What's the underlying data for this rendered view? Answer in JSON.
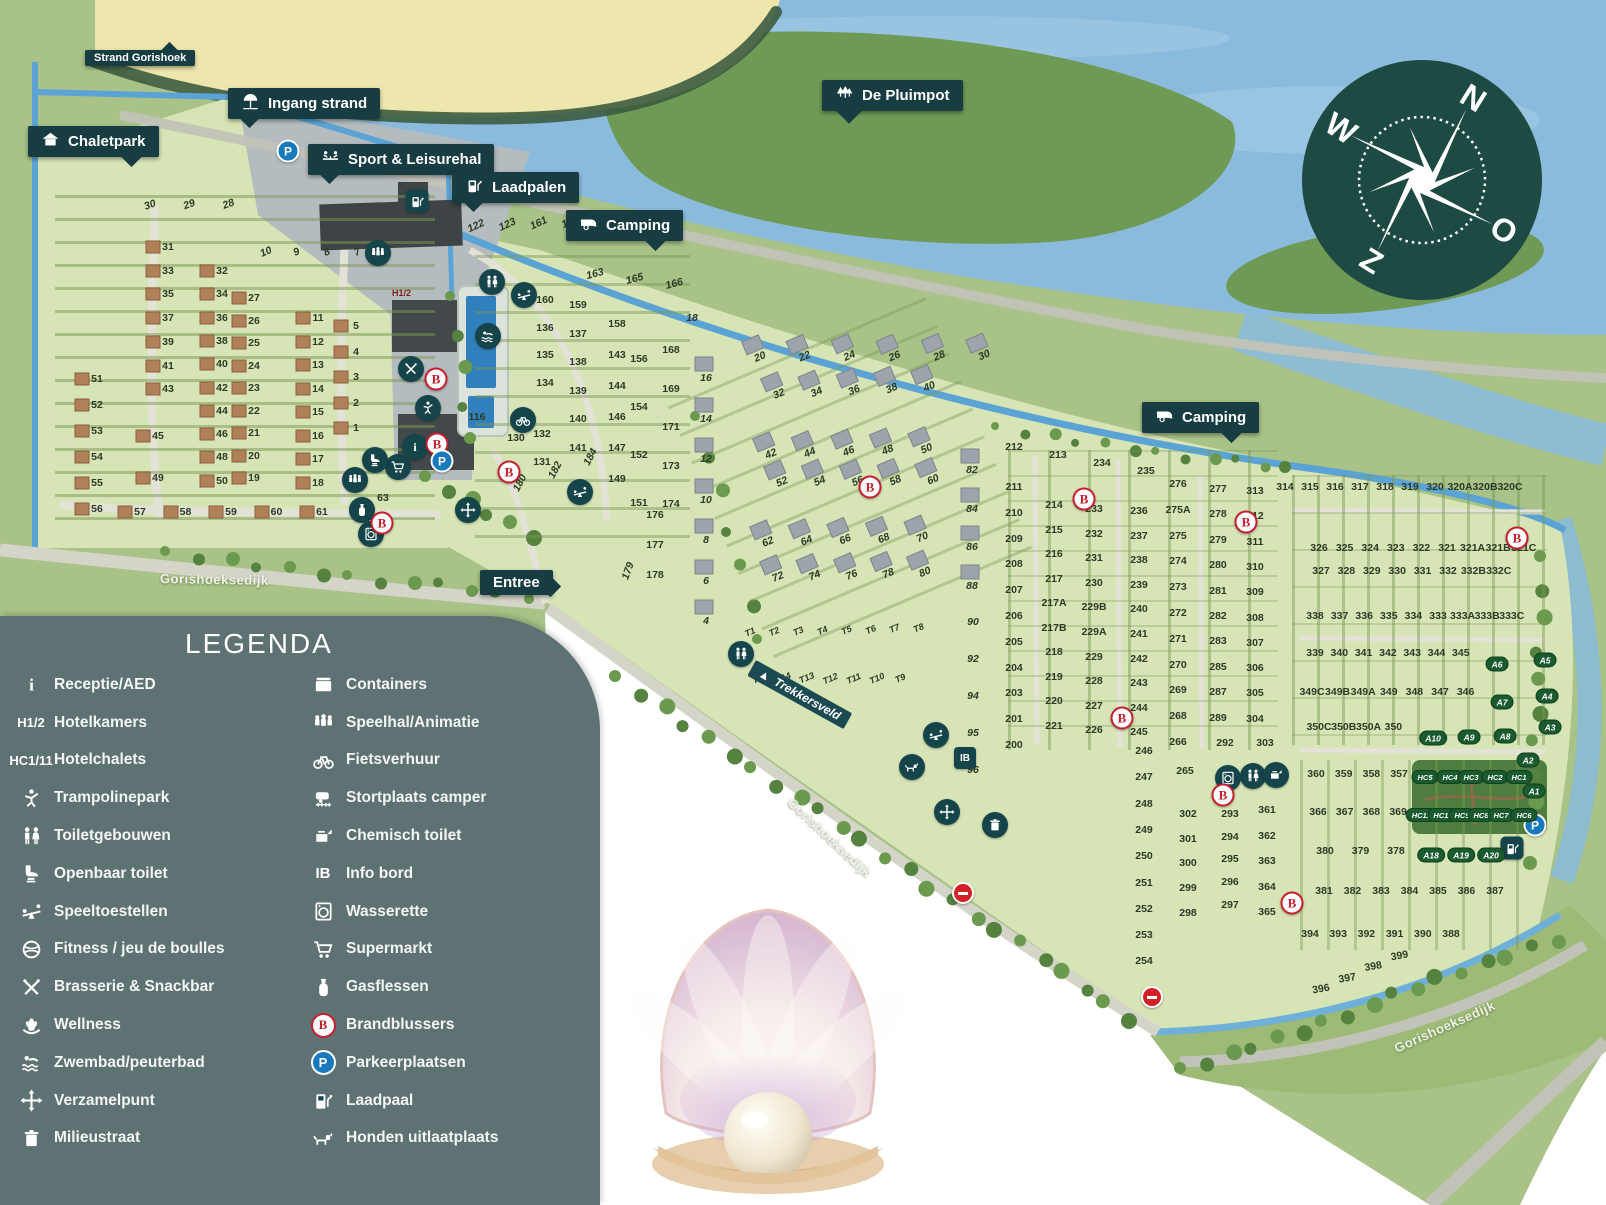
{
  "callouts": {
    "strand_gorishoek": "Strand Gorishoek",
    "ingang_strand": "Ingang strand",
    "chaletpark": "Chaletpark",
    "sport_leisurehal": "Sport & Leisurehal",
    "laadpalen": "Laadpalen",
    "camping_1": "Camping",
    "camping_2": "Camping",
    "de_pluimpot": "De Pluimpot",
    "entree": "Entree"
  },
  "map_labels": {
    "road_label": "Gorishoeksedijk",
    "trekkersveld": "Trekkersveld",
    "hotel_marker": "H1/2"
  },
  "legend": {
    "title": "LEGENDA",
    "left": [
      {
        "icon": "reception",
        "label": "Receptie/AED"
      },
      {
        "icon": "h12",
        "label": "Hotelkamers"
      },
      {
        "icon": "hc111",
        "label": "Hotelchalets"
      },
      {
        "icon": "trampoline",
        "label": "Trampolinepark"
      },
      {
        "icon": "toilets",
        "label": "Toiletgebouwen"
      },
      {
        "icon": "public-toilet",
        "label": "Openbaar toilet"
      },
      {
        "icon": "playground",
        "label": "Speeltoestellen"
      },
      {
        "icon": "fitness",
        "label": "Fitness / jeu de boulles"
      },
      {
        "icon": "brasserie",
        "label": "Brasserie & Snackbar"
      },
      {
        "icon": "wellness",
        "label": "Wellness"
      },
      {
        "icon": "swim",
        "label": "Zwembad/peuterbad"
      },
      {
        "icon": "assembly",
        "label": "Verzamelpunt"
      },
      {
        "icon": "waste",
        "label": "Milieustraat"
      }
    ],
    "right": [
      {
        "icon": "containers",
        "label": "Containers"
      },
      {
        "icon": "speelhal",
        "label": "Speelhal/Animatie"
      },
      {
        "icon": "bike",
        "label": "Fietsverhuur"
      },
      {
        "icon": "camper-dump",
        "label": "Stortplaats camper"
      },
      {
        "icon": "chem-toilet",
        "label": "Chemisch toilet"
      },
      {
        "icon": "info-board",
        "label": "Info bord"
      },
      {
        "icon": "laundry",
        "label": "Wasserette"
      },
      {
        "icon": "supermarket",
        "label": "Supermarkt"
      },
      {
        "icon": "gas",
        "label": "Gasflessen"
      },
      {
        "icon": "extinguisher",
        "label": "Brandblussers"
      },
      {
        "icon": "parking",
        "label": "Parkeerplaatsen"
      },
      {
        "icon": "charging",
        "label": "Laadpaal"
      },
      {
        "icon": "dog",
        "label": "Honden uitlaatplaats"
      }
    ],
    "text_icons": {
      "h12": "H1/2",
      "hc111": "HC1/11",
      "info-board": "IB"
    }
  },
  "compass": {
    "north": "N",
    "east": "O",
    "south": "Z",
    "west": "W"
  },
  "plots": {
    "chalet": {
      "c1": [
        31,
        33,
        35,
        37,
        39,
        41,
        43
      ],
      "c2": [
        32,
        34,
        36,
        38,
        40,
        42,
        44,
        46,
        48,
        50
      ],
      "c3": [
        27,
        26,
        25,
        24,
        23,
        22,
        21,
        20,
        19
      ],
      "c4": [
        11,
        12,
        13,
        14,
        15,
        16,
        17,
        18
      ],
      "c5": [
        5,
        4,
        3,
        2,
        1
      ],
      "c6": [
        51,
        52,
        53,
        54,
        55,
        56
      ],
      "c7": [
        45,
        49
      ],
      "r1": [
        57,
        58,
        59,
        60,
        61
      ],
      "d1": [
        30,
        29,
        28
      ],
      "d2": [
        10,
        9,
        8,
        7,
        6
      ],
      "s1": [
        63
      ]
    },
    "camp_west": {
      "w1": [
        122,
        123,
        161,
        162
      ],
      "w2": [
        163,
        165,
        166
      ],
      "w3": [
        160,
        136,
        135,
        134
      ],
      "w4": [
        132,
        131
      ],
      "w5": [
        159,
        137,
        138,
        139,
        140,
        141
      ],
      "w6": [
        158,
        143,
        144,
        146,
        147,
        149
      ],
      "w7": [
        156,
        154,
        152,
        151
      ],
      "w8": [
        168,
        169,
        171,
        173,
        174
      ],
      "w9": [
        176,
        177,
        178
      ],
      "w10": [
        116
      ],
      "w11": [
        130
      ],
      "w12": [
        180,
        182,
        184
      ],
      "w13": [
        179
      ]
    },
    "camp_central": {
      "g0": [
        16,
        14,
        12,
        10,
        8,
        6,
        4
      ],
      "g1": [
        20,
        22,
        24,
        26,
        28,
        30
      ],
      "g2": [
        32,
        34,
        36,
        38,
        40
      ],
      "g3": [
        42,
        44,
        46,
        48,
        50
      ],
      "g4": [
        52,
        54,
        56,
        58,
        60
      ],
      "g5": [
        62,
        64,
        66,
        68,
        70
      ],
      "g6": [
        72,
        74,
        76,
        78,
        80
      ],
      "g7": [
        82,
        84,
        86,
        88
      ],
      "g8": [
        90,
        92,
        94,
        95,
        96
      ],
      "g9": [
        18
      ],
      "t1": [
        "T1",
        "T2",
        "T3",
        "T4",
        "T5",
        "T6",
        "T7",
        "T8"
      ],
      "t2": [
        "T15",
        "T14",
        "T13",
        "T12",
        "T11",
        "T10",
        "T9"
      ]
    },
    "camp_east": {
      "e0": [
        212,
        213,
        234,
        235
      ],
      "e1": [
        211,
        210,
        209,
        208,
        207,
        206,
        205,
        204,
        203,
        201,
        200
      ],
      "e2": [
        214,
        215,
        216,
        217,
        "217A",
        "217B",
        218,
        219,
        220,
        221
      ],
      "e3": [
        233,
        232,
        231,
        230,
        "229B",
        "229A",
        229,
        228,
        227,
        226
      ],
      "e4": [
        236,
        237,
        238,
        239,
        240,
        241,
        242,
        243,
        244,
        245
      ],
      "e5": [
        276,
        "275A",
        275,
        274,
        273,
        272,
        271,
        270,
        269,
        268,
        266
      ],
      "e6": [
        277,
        278,
        279,
        280,
        281,
        282,
        283,
        285,
        287,
        289
      ],
      "e7": [
        313,
        312,
        311,
        310,
        309,
        308,
        307,
        306,
        305,
        304
      ],
      "e8": [
        246,
        247,
        248,
        249,
        250,
        251,
        252,
        253,
        254
      ],
      "e9": [
        265
      ],
      "e10": [
        302,
        301,
        300,
        299,
        298
      ],
      "e11": [
        292,
        303
      ],
      "e12": [
        293,
        294,
        295,
        296,
        297
      ],
      "e13": [
        361,
        362,
        363,
        364,
        365
      ],
      "e14": [
        360,
        359,
        358,
        357
      ],
      "e15": [
        366,
        367,
        368,
        369
      ],
      "e16": [
        380,
        379,
        378
      ],
      "e17": [
        381,
        382,
        383,
        384,
        385,
        386,
        387
      ],
      "e18": [
        394,
        393,
        392,
        391,
        390,
        388
      ],
      "e19": [
        396,
        397,
        398,
        399
      ]
    },
    "far_east": {
      "f1": [
        314,
        315,
        316,
        317,
        318,
        319,
        320,
        "320A",
        "320B",
        "320C"
      ],
      "f2": [
        326,
        325,
        324,
        323,
        322,
        321,
        "321A",
        "321B",
        "321C"
      ],
      "f3": [
        327,
        328,
        329,
        330,
        331,
        332,
        "332B",
        "332C"
      ],
      "f4": [
        338,
        337,
        336,
        335,
        334,
        333,
        "333A",
        "333B",
        "333C"
      ],
      "f5": [
        339,
        340,
        341,
        342,
        343,
        344,
        345
      ],
      "f6": [
        "349C",
        "349B",
        "349A",
        349,
        348,
        347,
        346
      ],
      "f7": [
        "350C",
        "350B",
        "350A",
        350
      ]
    }
  },
  "badges": {
    "a_badges": [
      "A6",
      "A5",
      "A7",
      "A4",
      "A10",
      "A9",
      "A8",
      "A3",
      "A2",
      "A1",
      "A18",
      "A19",
      "A20"
    ],
    "hc_badges": [
      "HC5",
      "HC4",
      "HC3",
      "HC2",
      "HC1",
      "HC11",
      "HC10",
      "HC9",
      "HC8",
      "HC7",
      "HC6"
    ]
  },
  "markers": [
    {
      "icon": "toilets",
      "x": 492,
      "y": 282
    },
    {
      "icon": "toilets",
      "x": 741,
      "y": 654
    },
    {
      "icon": "toilets",
      "x": 1253,
      "y": 776
    },
    {
      "icon": "playground",
      "x": 524,
      "y": 295
    },
    {
      "icon": "playground",
      "x": 580,
      "y": 492
    },
    {
      "icon": "playground",
      "x": 936,
      "y": 735
    },
    {
      "icon": "bike",
      "x": 523,
      "y": 420
    },
    {
      "icon": "speelhal",
      "x": 378,
      "y": 253
    },
    {
      "icon": "speelhal",
      "x": 355,
      "y": 480
    },
    {
      "icon": "swim",
      "x": 488,
      "y": 336
    },
    {
      "icon": "assembly",
      "x": 468,
      "y": 510
    },
    {
      "icon": "assembly",
      "x": 947,
      "y": 812
    },
    {
      "icon": "waste",
      "x": 995,
      "y": 825
    },
    {
      "icon": "reception",
      "x": 415,
      "y": 447
    },
    {
      "icon": "supermarket",
      "x": 398,
      "y": 467
    },
    {
      "icon": "public-toilet",
      "x": 375,
      "y": 460
    },
    {
      "icon": "trampoline",
      "x": 428,
      "y": 408
    },
    {
      "icon": "brasserie",
      "x": 411,
      "y": 369
    },
    {
      "icon": "gas",
      "x": 362,
      "y": 510
    },
    {
      "icon": "laundry",
      "x": 371,
      "y": 534
    },
    {
      "icon": "laundry",
      "x": 1228,
      "y": 778
    },
    {
      "icon": "chem-toilet",
      "x": 1276,
      "y": 775
    },
    {
      "icon": "dog",
      "x": 912,
      "y": 767
    },
    {
      "icon": "info-board",
      "x": 965,
      "y": 758
    },
    {
      "icon": "extinguisher",
      "x": 436,
      "y": 379
    },
    {
      "icon": "extinguisher",
      "x": 437,
      "y": 444
    },
    {
      "icon": "extinguisher",
      "x": 382,
      "y": 523
    },
    {
      "icon": "extinguisher",
      "x": 509,
      "y": 472
    },
    {
      "icon": "extinguisher",
      "x": 870,
      "y": 487
    },
    {
      "icon": "extinguisher",
      "x": 1084,
      "y": 499
    },
    {
      "icon": "extinguisher",
      "x": 1246,
      "y": 522
    },
    {
      "icon": "extinguisher",
      "x": 1122,
      "y": 718
    },
    {
      "icon": "extinguisher",
      "x": 1517,
      "y": 538
    },
    {
      "icon": "extinguisher",
      "x": 1223,
      "y": 795
    },
    {
      "icon": "extinguisher",
      "x": 1292,
      "y": 903
    },
    {
      "icon": "parking",
      "x": 288,
      "y": 151
    },
    {
      "icon": "parking",
      "x": 442,
      "y": 461
    },
    {
      "icon": "parking",
      "x": 1535,
      "y": 825
    },
    {
      "icon": "charging",
      "x": 417,
      "y": 201
    },
    {
      "icon": "charging",
      "x": 1512,
      "y": 848
    },
    {
      "icon": "no-entry",
      "x": 963,
      "y": 893
    },
    {
      "icon": "no-entry",
      "x": 1152,
      "y": 997
    }
  ]
}
